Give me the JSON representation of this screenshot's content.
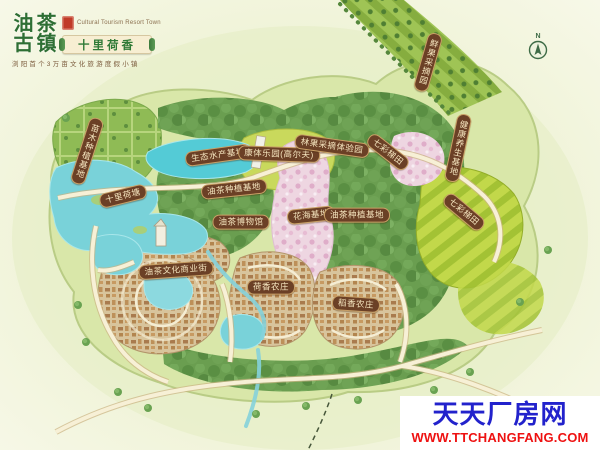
{
  "page": {
    "kind": "cultural tourism resort town master plan map",
    "width": 600,
    "height": 450
  },
  "logo": {
    "brand_chars": [
      "油",
      "茶",
      "古",
      "镇"
    ],
    "subtitle_en": "Cultural Tourism Resort Town",
    "banner_text": "十里荷香",
    "tagline": "浏阳首个3万亩文化旅游度假小镇",
    "colors": {
      "brand_green": "#2e6f34",
      "seal_red": "#c03a28",
      "tagline_brown": "#7b5b3c",
      "banner_bg": "#f7eed2"
    }
  },
  "compass": {
    "label": "N"
  },
  "label_style": {
    "bg": "#6b4026",
    "text": "#f5e5bf",
    "border": "#c9a066"
  },
  "map_labels": [
    {
      "text": "生态水产基地",
      "x": 218,
      "y": 155,
      "rot": -8
    },
    {
      "text": "康体乐园(高尔夫)",
      "x": 279,
      "y": 154,
      "rot": 2
    },
    {
      "text": "林果采摘体验园",
      "x": 332,
      "y": 146,
      "rot": 8
    },
    {
      "text": "七彩梯田",
      "x": 388,
      "y": 152,
      "rot": 38
    },
    {
      "text": "鲜果采摘园",
      "x": 428,
      "y": 62,
      "rot": 16,
      "vertical": true
    },
    {
      "text": "苗木种植基地",
      "x": 87,
      "y": 151,
      "rot": 18,
      "vertical": true
    },
    {
      "text": "十里荷塘",
      "x": 123,
      "y": 196,
      "rot": -14
    },
    {
      "text": "油茶种植基地",
      "x": 234,
      "y": 189,
      "rot": -6
    },
    {
      "text": "油茶博物馆",
      "x": 241,
      "y": 222,
      "rot": 0
    },
    {
      "text": "花海基地",
      "x": 311,
      "y": 215,
      "rot": -6
    },
    {
      "text": "油茶种植基地",
      "x": 357,
      "y": 215,
      "rot": 0
    },
    {
      "text": "健康养生基地",
      "x": 458,
      "y": 148,
      "rot": 12,
      "vertical": true
    },
    {
      "text": "七彩梯田",
      "x": 464,
      "y": 212,
      "rot": 40
    },
    {
      "text": "油茶文化商业街",
      "x": 176,
      "y": 270,
      "rot": -4
    },
    {
      "text": "荷香农庄",
      "x": 271,
      "y": 287,
      "rot": 0
    },
    {
      "text": "稻香农庄",
      "x": 356,
      "y": 304,
      "rot": 4
    }
  ],
  "watermark": {
    "site_name": "天天厂房网",
    "site_url": "WWW.TTCHANGFANG.COM",
    "name_color": "#2222cc",
    "url_color": "#ee1111",
    "bg": "#ffffff"
  }
}
